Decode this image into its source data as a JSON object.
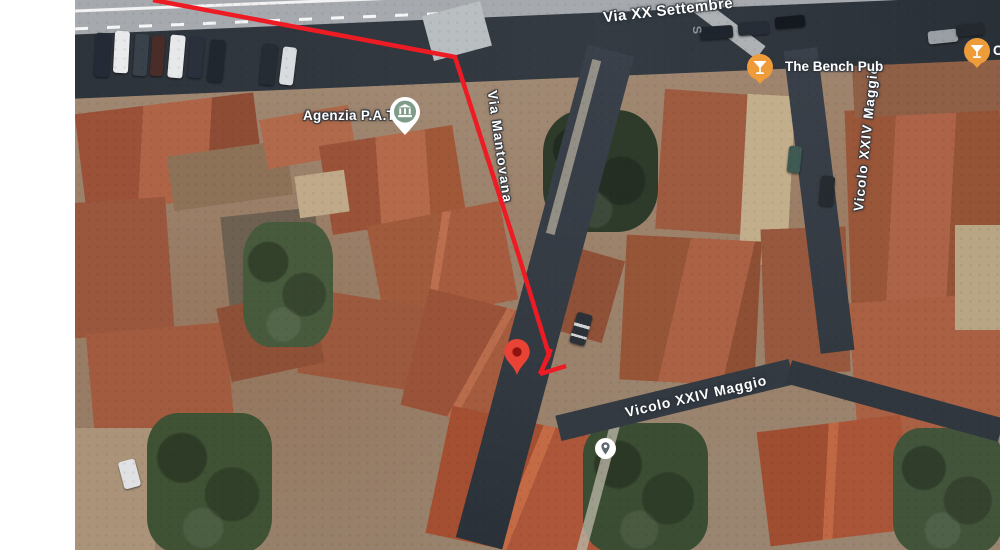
{
  "canvas": {
    "width": 1000,
    "height": 550,
    "left_margin_color": "#ffffff"
  },
  "labels": {
    "via_xx_settembre": "Via XX Settembre",
    "via_mantovana": "Via Mantovana",
    "vicolo_xxiv_maggio_right": "Vicolo XXIV Maggio",
    "vicolo_xxiv_maggio_center": "Vicolo XXIV Maggio",
    "faint_partial": "S"
  },
  "pois": {
    "agenzia": {
      "label": "Agenzia P.A.T.",
      "icon": "museum-pin-icon",
      "pin_color": "#ffffff",
      "badge_color": "#7e9c89",
      "glyph_color": "#ffffff"
    },
    "bench_pub": {
      "label": "The Bench Pub",
      "icon": "cocktail-bar-icon",
      "fill": "#EE9B3A",
      "glyph_color": "#ffffff"
    },
    "edge_bar": {
      "label": "C",
      "icon": "cocktail-bar-icon",
      "fill": "#EE9B3A",
      "glyph_color": "#ffffff"
    },
    "generic_place": {
      "icon": "location-pin-icon",
      "fill": "#ffffff",
      "glyph_color": "#5d686f"
    }
  },
  "route": {
    "color": "#ED1C24",
    "stroke_width": 4.5,
    "points": "153,0 455,57 517,250 549,355 540,374",
    "arrow_barb_1": "540,374 566,366",
    "arrow_barb_2": "540,374 551,349"
  },
  "marker": {
    "fill": "#E94335",
    "dot_color": "#8E1410"
  }
}
